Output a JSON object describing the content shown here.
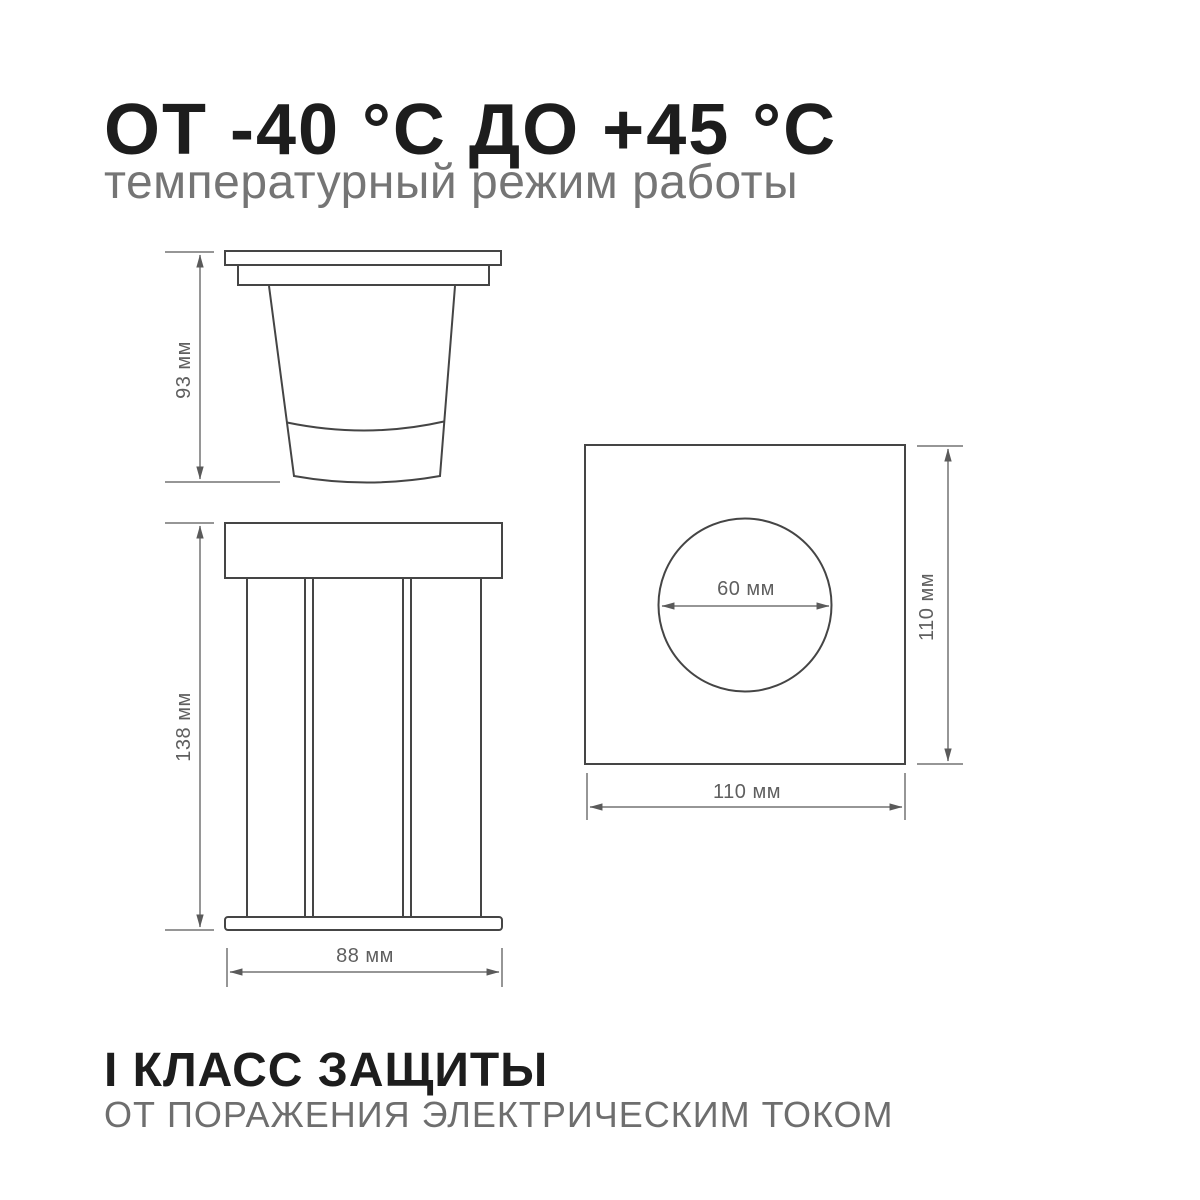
{
  "header": {
    "title": "ОТ -40 °C ДО +45 °C",
    "subtitle": "температурный режим работы"
  },
  "footer": {
    "title": "I КЛАСС ЗАЩИТЫ",
    "subtitle": "ОТ ПОРАЖЕНИЯ ЭЛЕКТРИЧЕСКИМ ТОКОМ"
  },
  "dimensions": {
    "side_view_height": "93 мм",
    "front_view_height": "138 мм",
    "front_view_width": "88 мм",
    "cutout_diameter": "60 мм",
    "faceplate_height": "110 мм",
    "faceplate_width": "110 мм"
  },
  "colors": {
    "text_primary": "#1d1d1d",
    "text_secondary": "#757575",
    "drawing_line": "#454545",
    "dimension_line": "#737373",
    "background": "#ffffff"
  }
}
